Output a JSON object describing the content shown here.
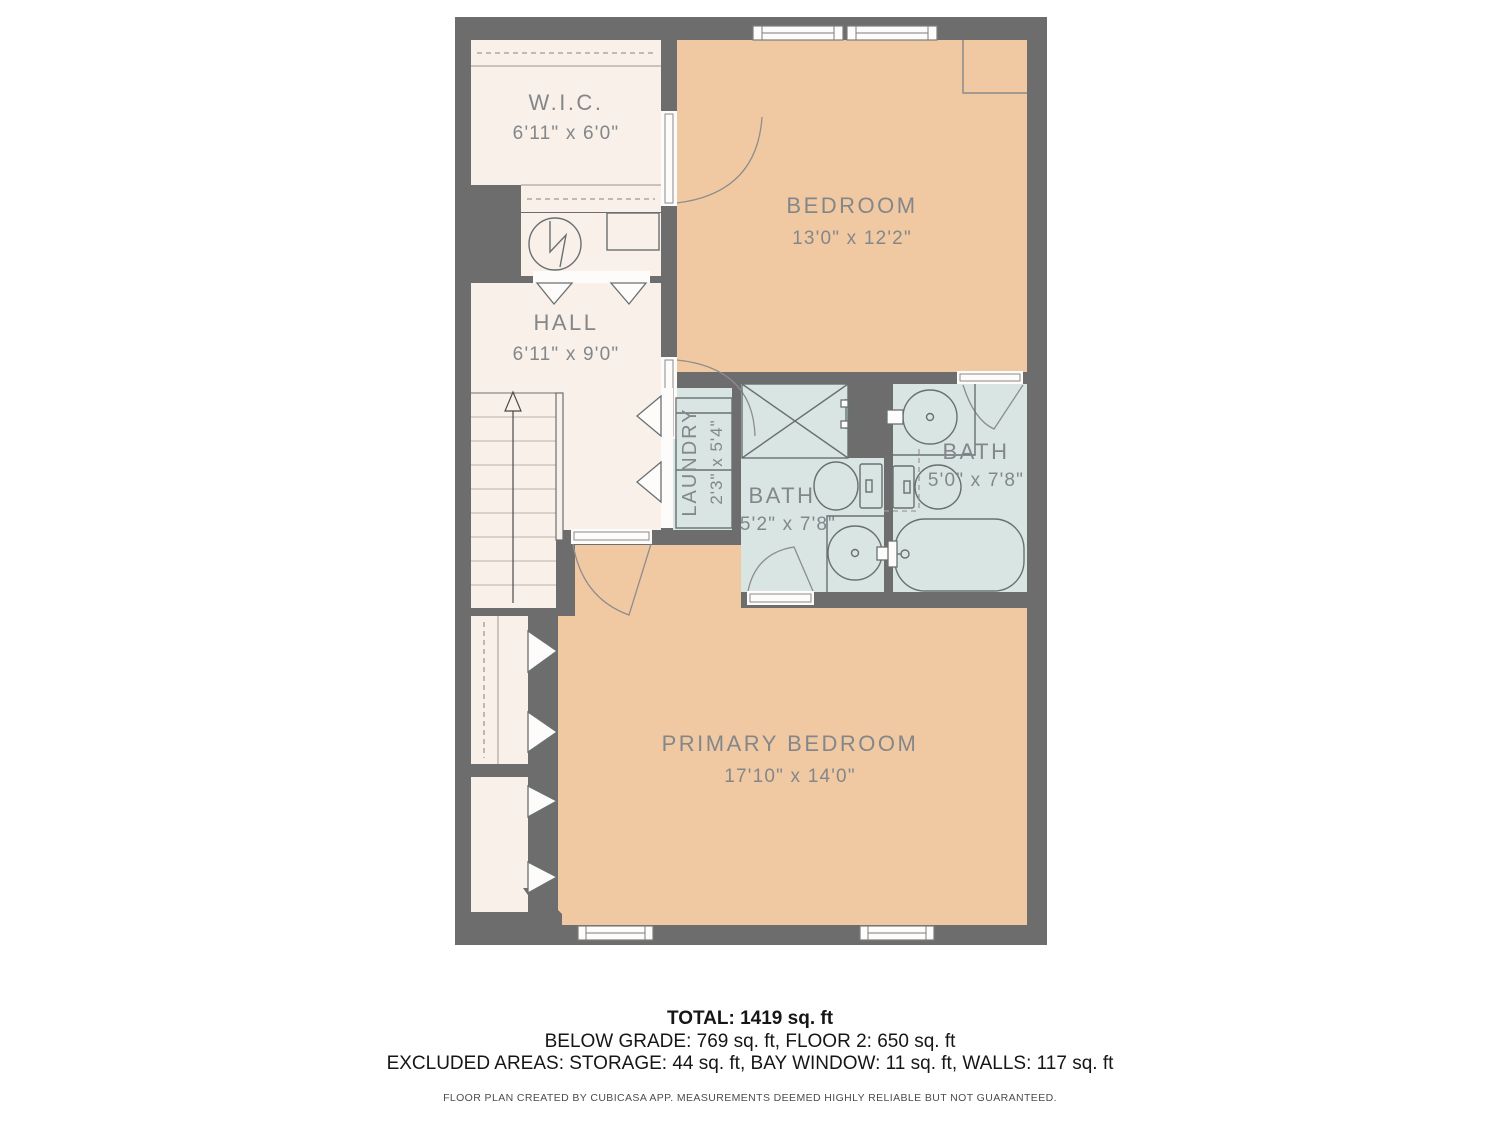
{
  "floor_plan": {
    "rooms": {
      "wic": {
        "name": "W.I.C.",
        "dims": "6'11\" x 6'0\""
      },
      "bedroom": {
        "name": "BEDROOM",
        "dims": "13'0\" x 12'2\""
      },
      "hall": {
        "name": "HALL",
        "dims": "6'11\" x 9'0\""
      },
      "laundry": {
        "name": "LAUNDRY",
        "dims": "2'3\" x 5'4\""
      },
      "bath_primary": {
        "name": "BATH",
        "dims": "5'2\" x 7'8\""
      },
      "bath_second": {
        "name": "BATH",
        "dims": "5'0\" x 7'8\""
      },
      "primary_bedroom": {
        "name": "PRIMARY BEDROOM",
        "dims": "17'10\" x 14'0\""
      }
    },
    "footer": {
      "total": "TOTAL: 1419 sq. ft",
      "grades": "BELOW GRADE: 769 sq. ft, FLOOR 2: 650 sq. ft",
      "excluded": "EXCLUDED AREAS: STORAGE: 44 sq. ft, BAY WINDOW: 11 sq. ft, WALLS: 117 sq. ft",
      "disclaimer": "FLOOR PLAN CREATED BY CUBICASA APP. MEASUREMENTS DEEMED HIGHLY RELIABLE BUT NOT GUARANTEED."
    },
    "colors": {
      "wall": "#6d6d6d",
      "floor_warm": "#f0c9a2",
      "floor_light": "#f8f0e9",
      "floor_wet": "#d8e5e2",
      "label": "#84878a",
      "opening": "#fdfcfa"
    }
  }
}
